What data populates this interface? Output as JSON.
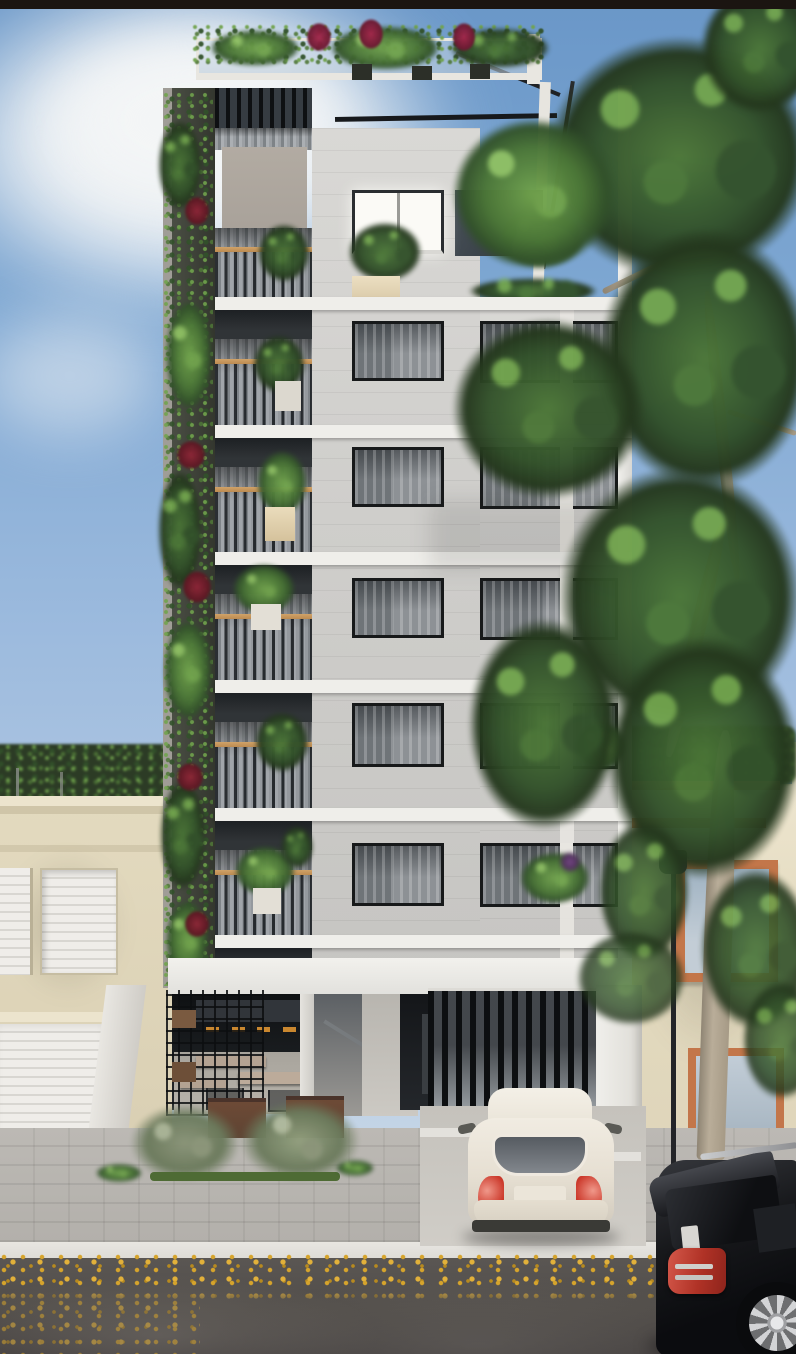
{
  "scene": {
    "label": "Photorealistic 3D exterior rendering of a narrow modern multi-storey apartment building with a vertical garden strip, planted roof terrace, glass balconies, a ground-floor cafe terrace and gated car entrance; beige neighbouring houses on both sides, a tall street tree and lamp post on the right, a white hatchback parked in the driveway and a black SUV parked on the wet street with fallen yellow leaves",
    "objects": [
      "sky",
      "clouds",
      "background-treeline",
      "left-neighbour-house",
      "garage-door",
      "shutter-windows",
      "main-building",
      "rooftop-planters",
      "glass-balustrade",
      "pergola",
      "vertical-garden-wall",
      "balcony-floors",
      "curtained-windows",
      "bright-window",
      "facade-panels",
      "ground-floor-cafe",
      "bar-stools",
      "terrace-tables",
      "steel-mesh-shelving",
      "street-planters",
      "entrance-lobby",
      "slatted-gate",
      "driveway",
      "right-neighbour-house",
      "terracotta-framed-windows",
      "roof-terrace-rails",
      "street-lamp",
      "street-tree",
      "white-hatchback-car",
      "black-suv",
      "sidewalk",
      "curb",
      "wet-road",
      "fallen-leaves"
    ]
  },
  "colors": {
    "frame_bar": "#1b1511",
    "sky_top": "#6a97c8",
    "sky_mid": "#9dbbde",
    "sky_low": "#bccfe4",
    "cloud": "#f3f5f6",
    "slab_white": "#efeeea",
    "facade_light": "#d3d2cf",
    "taupe_block": "#a9a29a",
    "awning_dark": "#303437",
    "wood_rail": "#bc8b51",
    "green_deep": "#24371d",
    "green_dark": "#32512a",
    "green_mid": "#4b7637",
    "green_bright": "#71a34d",
    "red_accent": "#8e2637",
    "beige_wall": "#e3dabf",
    "beige_light": "#ece4cd",
    "terracotta": "#c3764a",
    "sidewalk": "#b2afaa",
    "curb": "#dedcd7",
    "asphalt": "#514d49",
    "leaf_yellow": "#d6a42c",
    "car_white": "#ece6da",
    "taillight": "#cc3a2c",
    "suv_black": "#101114",
    "trunk_tan": "#b9ad99",
    "lamp_dark": "#232428",
    "planter_brown": "#5e4433",
    "stool_orange": "#c9872f"
  }
}
